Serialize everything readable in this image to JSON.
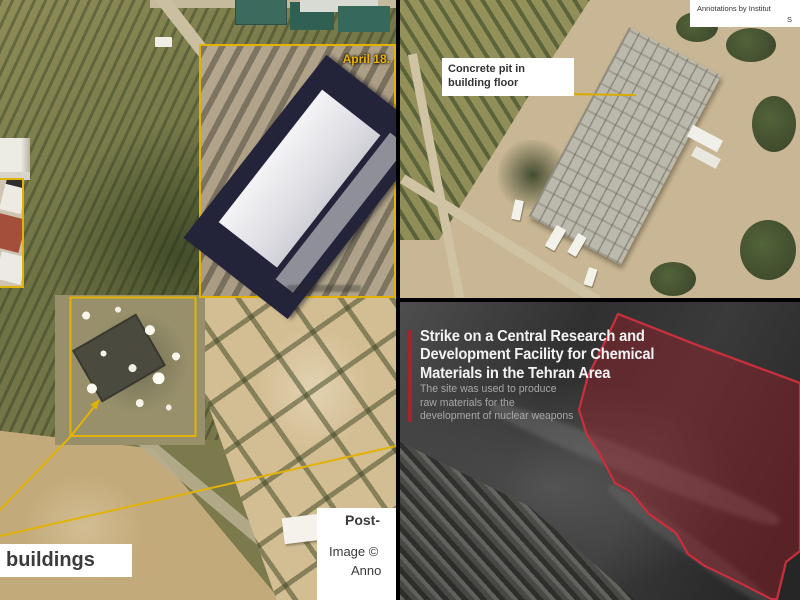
{
  "colors": {
    "annotation_yellow": "#e2b306",
    "strike_red_stroke": "#c5303c",
    "strike_red_fill": "rgba(158,28,40,0.42)",
    "accent_bar_red": "#a6242c",
    "label_text": "#3b3b3b",
    "title_white": "#f2f2f2",
    "subtitle_gray": "#a8a8a8"
  },
  "left_panel": {
    "inset_date_label": "April 18.",
    "destroyed_buildings_label": "buildings",
    "caption": {
      "line1": "Post-",
      "line2": "Image © ",
      "line3": "Anno"
    }
  },
  "top_right_panel": {
    "callout": "Concrete pit in building floor",
    "credit_line1": "Annotations by Institut",
    "credit_line2": "S"
  },
  "bottom_right_panel": {
    "title_line1": "Strike on a Central Research and",
    "title_line2": "Development Facility for Chemical",
    "title_line3": "Materials in the Tehran Area",
    "subtitle_line1": "The site was used to produce",
    "subtitle_line2": "raw materials for the",
    "subtitle_line3": "development of nuclear weapons"
  }
}
